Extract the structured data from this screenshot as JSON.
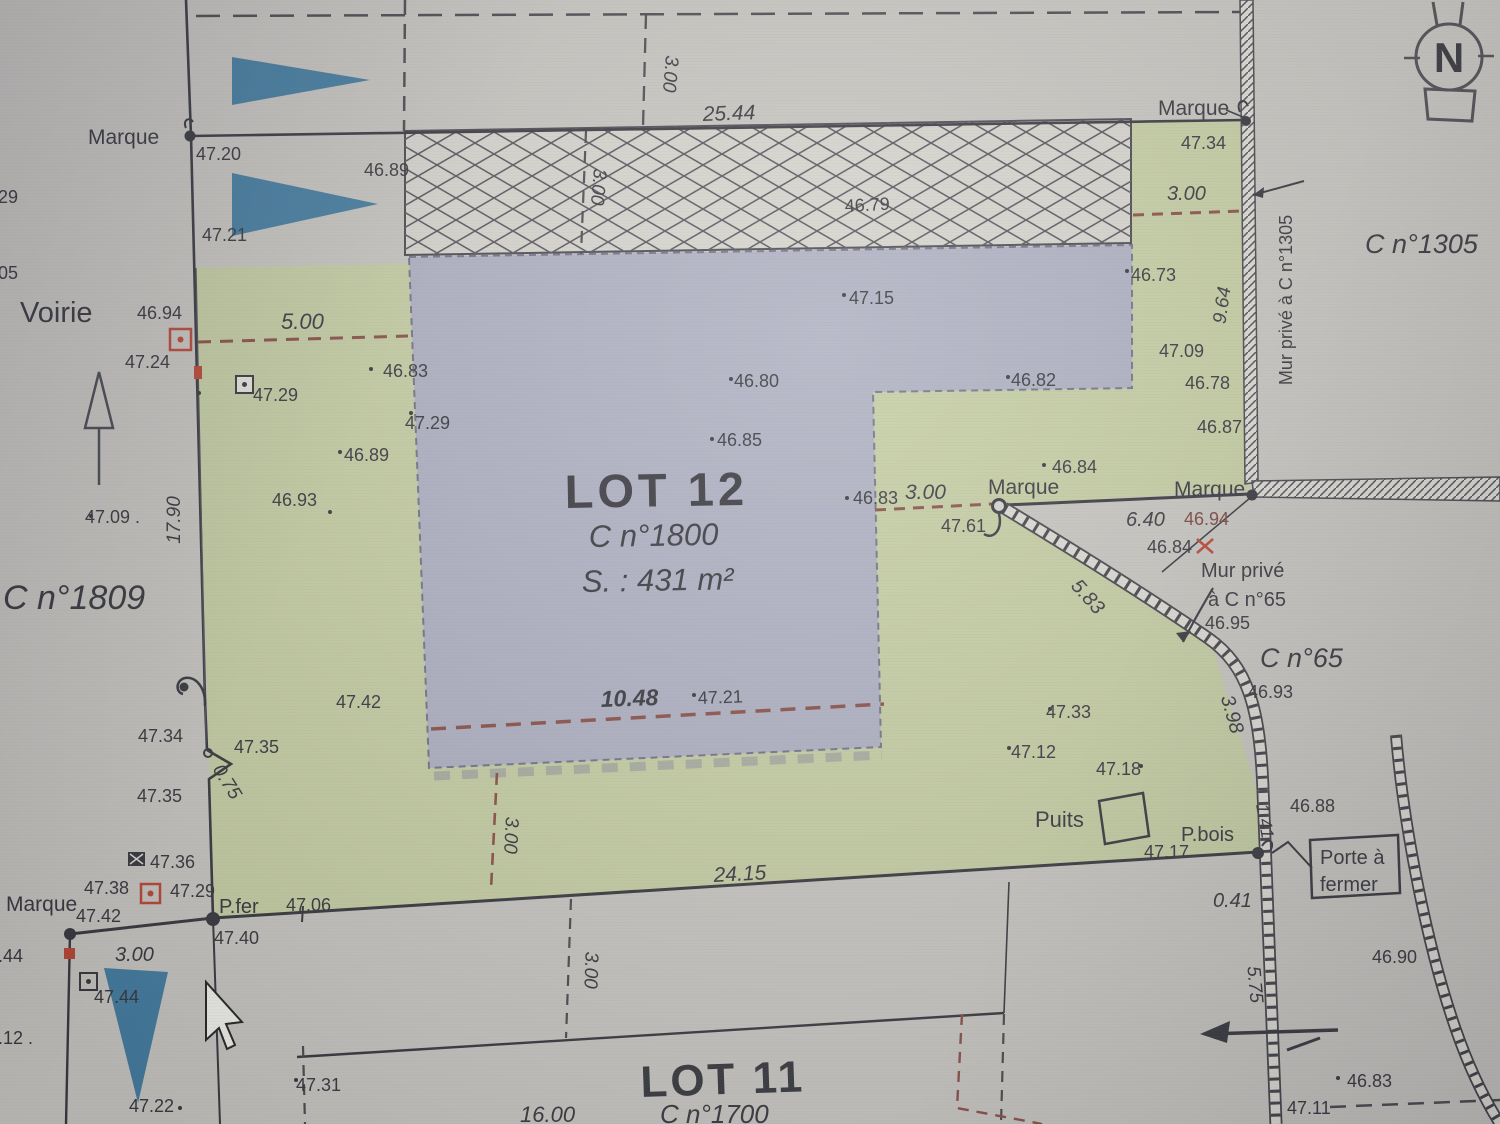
{
  "document": {
    "type": "cadastral-division-plan",
    "visible_parcels": [
      "LOT 12",
      "LOT 11",
      "C n°1809",
      "C n°1305",
      "C n°65",
      "C n°1700"
    ],
    "lot12": {
      "title": "LOT 12",
      "parcel": "C n°1800",
      "area": "S. : 431 m²"
    }
  },
  "colors": {
    "paper": "#c8c6c0",
    "paper2": "#dedcd4",
    "green": "#c6cfa0",
    "lav": "#aeb0c5",
    "hatchbg": "#d8d6ce",
    "ink": "#34343c",
    "maroon": "#8d4a42",
    "blue": "#3c7ca3",
    "red": "#c2402e",
    "wall": "#44444c"
  },
  "survey_dots": [
    [
      371,
      369
    ],
    [
      199,
      393
    ],
    [
      411,
      413
    ],
    [
      340,
      452
    ],
    [
      330,
      512
    ],
    [
      731,
      379
    ],
    [
      712,
      439
    ],
    [
      844,
      295
    ],
    [
      1008,
      377
    ],
    [
      1127,
      271
    ],
    [
      1044,
      465
    ],
    [
      847,
      498
    ],
    [
      1050,
      709
    ],
    [
      1009,
      748
    ],
    [
      694,
      695
    ],
    [
      1141,
      766
    ],
    [
      296,
      1080
    ],
    [
      180,
      1108
    ],
    [
      1338,
      1078
    ],
    [
      91,
      516
    ]
  ],
  "labels": [
    {
      "t": "Marque",
      "x": 88,
      "y": 144,
      "s": 21,
      "n": "marque-label-top-left"
    },
    {
      "t": "47.20",
      "x": 196,
      "y": 160,
      "s": 18
    },
    {
      "t": "46.89",
      "x": 364,
      "y": 176,
      "s": 18
    },
    {
      "t": "47.21",
      "x": 202,
      "y": 241,
      "s": 18
    },
    {
      "t": "47.29",
      "x": -27,
      "y": 203,
      "s": 18
    },
    {
      "t": "47.05",
      "x": -27,
      "y": 279,
      "s": 18
    },
    {
      "t": "3.00",
      "x": 666,
      "y": 55,
      "s": 19,
      "r": 95,
      "i": 1
    },
    {
      "t": "25.44",
      "x": 703,
      "y": 121,
      "s": 21,
      "r": -2,
      "i": 1
    },
    {
      "t": "46.79",
      "x": 845,
      "y": 212,
      "s": 18,
      "r": -3
    },
    {
      "t": "3.00",
      "x": 594,
      "y": 168,
      "s": 19,
      "r": 95,
      "i": 1
    },
    {
      "t": "Marque",
      "x": 1158,
      "y": 115,
      "s": 21,
      "n": "marque-label-top-right"
    },
    {
      "t": "47.34",
      "x": 1181,
      "y": 149,
      "s": 18
    },
    {
      "t": "3.00",
      "x": 1167,
      "y": 200,
      "s": 20,
      "i": 1
    },
    {
      "t": "C n°1305",
      "x": 1365,
      "y": 253,
      "s": 27,
      "i": 1,
      "n": "parcel-label-c1305"
    },
    {
      "t": "Mur privé à C n°1305",
      "x": 1292,
      "y": 300,
      "s": 18,
      "r": -90,
      "a": "middle",
      "n": "wall-label-c1305"
    },
    {
      "t": "9.64",
      "x": 1228,
      "y": 306,
      "s": 19,
      "r": -82,
      "i": 1,
      "a": "middle"
    },
    {
      "t": "46.73",
      "x": 1131,
      "y": 281,
      "s": 18
    },
    {
      "t": "Voirie",
      "x": 20,
      "y": 322,
      "s": 29,
      "n": "road-label-voirie"
    },
    {
      "t": "46.94",
      "x": 137,
      "y": 319,
      "s": 18
    },
    {
      "t": "47.24",
      "x": 125,
      "y": 368,
      "s": 18
    },
    {
      "t": "5.00",
      "x": 281,
      "y": 329,
      "s": 22,
      "i": 1
    },
    {
      "t": "46.83",
      "x": 383,
      "y": 377,
      "s": 18
    },
    {
      "t": "47.29",
      "x": 253,
      "y": 401,
      "s": 18
    },
    {
      "t": "47.29",
      "x": 405,
      "y": 429,
      "s": 18
    },
    {
      "t": "46.89",
      "x": 344,
      "y": 461,
      "s": 18
    },
    {
      "t": "46.80",
      "x": 734,
      "y": 387,
      "s": 18
    },
    {
      "t": "47.15",
      "x": 849,
      "y": 304,
      "s": 18
    },
    {
      "t": "46.82",
      "x": 1011,
      "y": 386,
      "s": 18
    },
    {
      "t": "47.09",
      "x": 1159,
      "y": 357,
      "s": 18
    },
    {
      "t": "46.78",
      "x": 1185,
      "y": 389,
      "s": 18
    },
    {
      "t": "46.87",
      "x": 1197,
      "y": 433,
      "s": 18
    },
    {
      "t": "46.93",
      "x": 272,
      "y": 506,
      "s": 18
    },
    {
      "t": "17.90",
      "x": 180,
      "y": 520,
      "s": 19,
      "r": -90,
      "i": 1,
      "a": "middle"
    },
    {
      "t": "47.09 .",
      "x": 85,
      "y": 523,
      "s": 18
    },
    {
      "t": "C n°1809",
      "x": 3,
      "y": 609,
      "s": 34,
      "i": 1,
      "n": "parcel-label-c1809"
    },
    {
      "t": "LOT 12",
      "x": 565,
      "y": 508,
      "s": 47,
      "b": 1,
      "ls": 4,
      "r": -1,
      "n": "lot12-title"
    },
    {
      "t": "C n°1800",
      "x": 589,
      "y": 547,
      "s": 31,
      "i": 1,
      "r": -1,
      "n": "lot12-parcel"
    },
    {
      "t": "S. : 431 m²",
      "x": 582,
      "y": 592,
      "s": 31,
      "i": 1,
      "r": -1,
      "n": "lot12-area"
    },
    {
      "t": "46.85",
      "x": 717,
      "y": 446,
      "s": 18
    },
    {
      "t": "46.83",
      "x": 853,
      "y": 504,
      "s": 18
    },
    {
      "t": "3.00",
      "x": 905,
      "y": 499,
      "s": 21,
      "i": 1
    },
    {
      "t": "Marque",
      "x": 988,
      "y": 494,
      "s": 21,
      "n": "marque-label-mid-left"
    },
    {
      "t": "47.61",
      "x": 941,
      "y": 532,
      "s": 18
    },
    {
      "t": "46.84",
      "x": 1052,
      "y": 473,
      "s": 18
    },
    {
      "t": "Marque",
      "x": 1174,
      "y": 496,
      "s": 21,
      "n": "marque-label-mid-right"
    },
    {
      "t": "6.40",
      "x": 1126,
      "y": 526,
      "s": 20,
      "i": 1
    },
    {
      "t": "46.94",
      "x": 1184,
      "y": 525,
      "s": 18,
      "c": "#7c4038"
    },
    {
      "t": "46.84",
      "x": 1147,
      "y": 553,
      "s": 18
    },
    {
      "t": "Mur privé",
      "x": 1201,
      "y": 577,
      "s": 20,
      "n": "wall-label-c65-line1"
    },
    {
      "t": "à C n°65",
      "x": 1208,
      "y": 606,
      "s": 20,
      "n": "wall-label-c65-line2"
    },
    {
      "t": "46.95",
      "x": 1205,
      "y": 629,
      "s": 18
    },
    {
      "t": "C n°65",
      "x": 1260,
      "y": 667,
      "s": 27,
      "i": 1,
      "n": "parcel-label-c65"
    },
    {
      "t": "5.83",
      "x": 1083,
      "y": 601,
      "s": 20,
      "r": 48,
      "i": 1,
      "a": "middle"
    },
    {
      "t": "3.98",
      "x": 1226,
      "y": 716,
      "s": 20,
      "r": 74,
      "i": 1,
      "a": "middle"
    },
    {
      "t": "46.93",
      "x": 1248,
      "y": 698,
      "s": 18
    },
    {
      "t": "47.42",
      "x": 336,
      "y": 708,
      "s": 18
    },
    {
      "t": "10.48",
      "x": 601,
      "y": 707,
      "s": 23,
      "i": 1,
      "b": 1,
      "r": -2
    },
    {
      "t": "47.21",
      "x": 698,
      "y": 704,
      "s": 18,
      "r": -2
    },
    {
      "t": "47.34",
      "x": 138,
      "y": 742,
      "s": 18
    },
    {
      "t": "47.35",
      "x": 234,
      "y": 753,
      "s": 18
    },
    {
      "t": "0.75",
      "x": 222,
      "y": 785,
      "s": 19,
      "r": 58,
      "i": 1,
      "a": "middle"
    },
    {
      "t": "47.35",
      "x": 137,
      "y": 802,
      "s": 18
    },
    {
      "t": "47.33",
      "x": 1046,
      "y": 718,
      "s": 18
    },
    {
      "t": "47.12",
      "x": 1011,
      "y": 758,
      "s": 18
    },
    {
      "t": "47.18",
      "x": 1096,
      "y": 775,
      "s": 18
    },
    {
      "t": "Puits",
      "x": 1035,
      "y": 827,
      "s": 22,
      "n": "well-label"
    },
    {
      "t": "P.bois",
      "x": 1181,
      "y": 841,
      "s": 20,
      "n": "pbois-label"
    },
    {
      "t": "47.17",
      "x": 1144,
      "y": 858,
      "s": 18
    },
    {
      "t": "1.41",
      "x": 1259,
      "y": 822,
      "s": 18,
      "r": 80,
      "i": 1,
      "a": "middle"
    },
    {
      "t": "46.88",
      "x": 1290,
      "y": 812,
      "s": 18
    },
    {
      "t": "Porte à",
      "x": 1320,
      "y": 864,
      "s": 20,
      "n": "gate-label-line1"
    },
    {
      "t": "fermer",
      "x": 1320,
      "y": 891,
      "s": 20,
      "n": "gate-label-line2"
    },
    {
      "t": "0.41",
      "x": 1213,
      "y": 907,
      "s": 20,
      "i": 1
    },
    {
      "t": "24.15",
      "x": 714,
      "y": 882,
      "s": 21,
      "i": 1,
      "r": -3
    },
    {
      "t": "3.00",
      "x": 505,
      "y": 835,
      "s": 19,
      "r": 93,
      "i": 1,
      "a": "middle"
    },
    {
      "t": "47.36",
      "x": 150,
      "y": 868,
      "s": 18
    },
    {
      "t": "47.38",
      "x": 84,
      "y": 894,
      "s": 18
    },
    {
      "t": "47.29",
      "x": 170,
      "y": 897,
      "s": 18
    },
    {
      "t": "Marque",
      "x": 6,
      "y": 911,
      "s": 21,
      "n": "marque-label-bottom-left"
    },
    {
      "t": "47.42",
      "x": 76,
      "y": 922,
      "s": 18
    },
    {
      "t": "P.fer",
      "x": 219,
      "y": 913,
      "s": 20,
      "n": "pfer-label"
    },
    {
      "t": "47.06",
      "x": 286,
      "y": 911,
      "s": 18
    },
    {
      "t": "47.40",
      "x": 214,
      "y": 944,
      "s": 18
    },
    {
      "t": "47.44",
      "x": -22,
      "y": 962,
      "s": 18
    },
    {
      "t": "3.00",
      "x": 115,
      "y": 961,
      "s": 20,
      "i": 1
    },
    {
      "t": "47.44",
      "x": 94,
      "y": 1003,
      "s": 18
    },
    {
      "t": "47.12 .",
      "x": -22,
      "y": 1044,
      "s": 18
    },
    {
      "t": "47.22",
      "x": 129,
      "y": 1112,
      "s": 18
    },
    {
      "t": "47.31",
      "x": 296,
      "y": 1091,
      "s": 18
    },
    {
      "t": "LOT 11",
      "x": 641,
      "y": 1097,
      "s": 44,
      "b": 1,
      "ls": 3,
      "r": -2,
      "n": "lot11-title"
    },
    {
      "t": "3.00",
      "x": 585,
      "y": 970,
      "s": 19,
      "r": 92,
      "i": 1,
      "a": "middle"
    },
    {
      "t": "5.75",
      "x": 1249,
      "y": 985,
      "s": 19,
      "r": 85,
      "i": 1,
      "a": "middle"
    },
    {
      "t": "46.90",
      "x": 1372,
      "y": 963,
      "s": 18
    },
    {
      "t": "46.83",
      "x": 1347,
      "y": 1087,
      "s": 18
    },
    {
      "t": "47.11",
      "x": 1287,
      "y": 1114,
      "s": 18
    },
    {
      "t": "16.00",
      "x": 520,
      "y": 1122,
      "s": 22,
      "i": 1
    },
    {
      "t": "C n°1700",
      "x": 660,
      "y": 1123,
      "s": 26,
      "i": 1,
      "n": "parcel-label-c1700"
    },
    {
      "t": "N",
      "x": 1449,
      "y": 72,
      "s": 42,
      "b": 1,
      "a": "middle",
      "n": "compass-n-label"
    }
  ]
}
